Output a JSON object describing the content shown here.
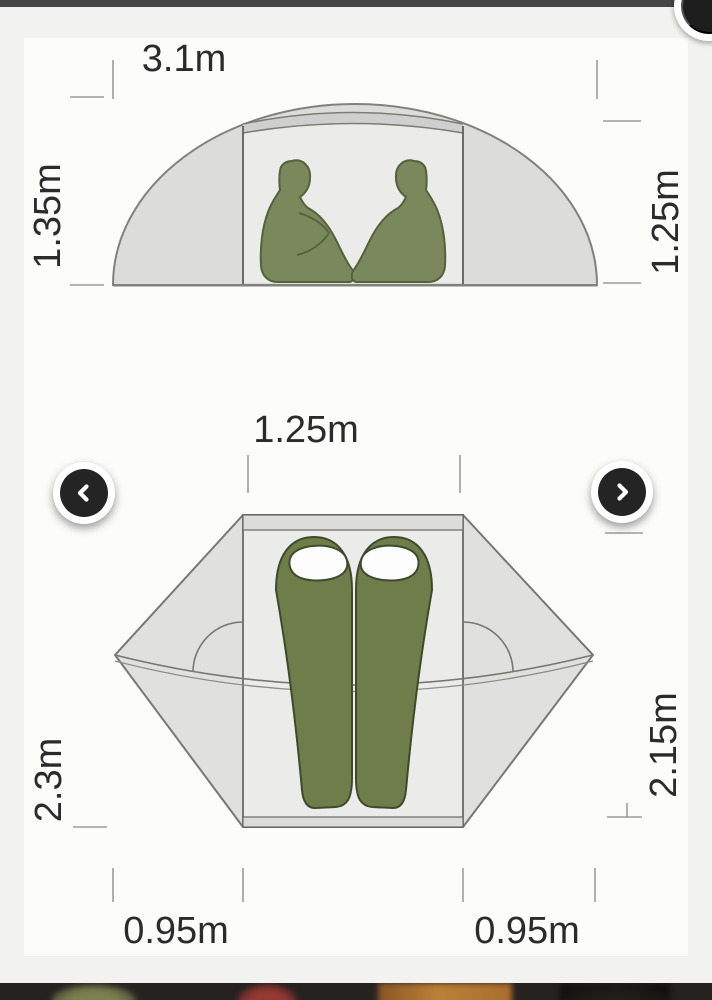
{
  "carousel": {
    "prev_icon": "chevron-left",
    "next_icon": "chevron-right"
  },
  "side_view": {
    "width_label": "3.1m",
    "height_left_label": "1.35m",
    "height_right_label": "1.25m"
  },
  "floor_plan": {
    "inner_width_label": "1.25m",
    "length_left_label": "2.3m",
    "length_right_label": "2.15m",
    "vestibule_left_label": "0.95m",
    "vestibule_right_label": "0.95m"
  },
  "colors": {
    "figure_olive": "#7b885c",
    "figure_outline": "#55613c",
    "bag_olive": "#6e7d49",
    "bag_outline": "#3f4a2c",
    "tent_fill": "#dcdcda",
    "tent_inner_fill": "#ebebe9",
    "tent_outline": "#82827c",
    "dimension_text": "#2b2b2b",
    "tick_line": "#9c9c99",
    "top_bar": "#454545",
    "thumbnail_strip_bg": "#262220"
  },
  "thumbnails": {
    "items": [
      {
        "name": "green-tent-thumbnail",
        "color": "#7d8050"
      },
      {
        "name": "red-tent-thumbnail",
        "color": "#943a33"
      },
      {
        "name": "orange-photo-thumbnail",
        "color": "#bb8136"
      },
      {
        "name": "dark-photo-thumbnail",
        "color": "#0e0c0a"
      }
    ]
  }
}
